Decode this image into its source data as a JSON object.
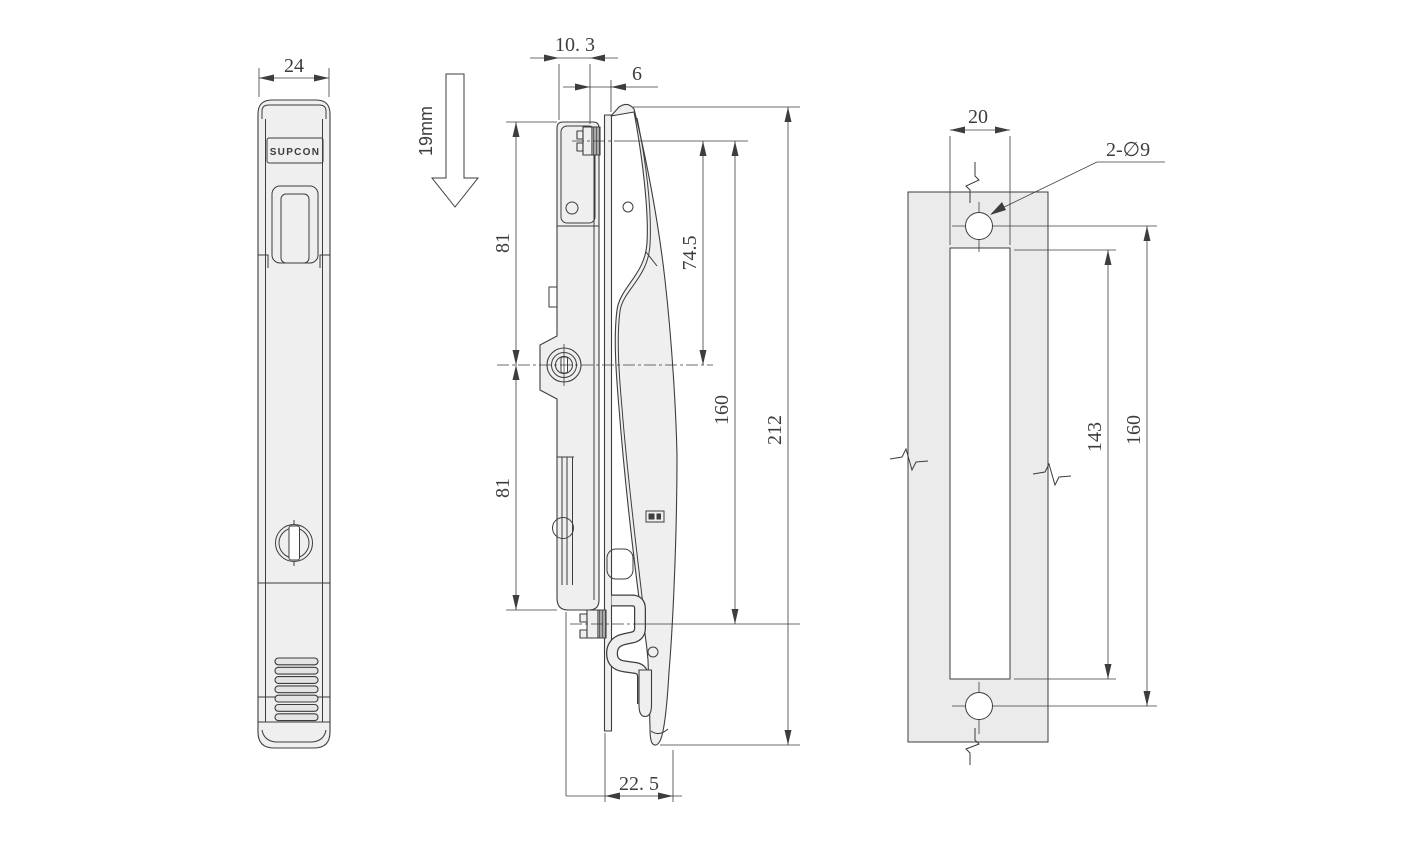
{
  "brand": "SUPCON",
  "front_view": {
    "dims": {
      "width": "24"
    }
  },
  "side_view": {
    "note": "19mm",
    "dims": {
      "depth": "10. 3",
      "gap": "6",
      "upper": "81",
      "lower": "81",
      "offset": "74.5",
      "pitch": "160",
      "length": "212",
      "hook": "22. 5"
    }
  },
  "cutout_view": {
    "dims": {
      "slot_width": "20",
      "holes": "2-∅9",
      "slot_length": "143",
      "hole_pitch": "160"
    }
  },
  "colors": {
    "line": "#3d3d3d",
    "part_fill": "#efefef",
    "panel_fill": "#ebebeb",
    "rib_fill": "#e4e4e4",
    "background": "#ffffff"
  }
}
